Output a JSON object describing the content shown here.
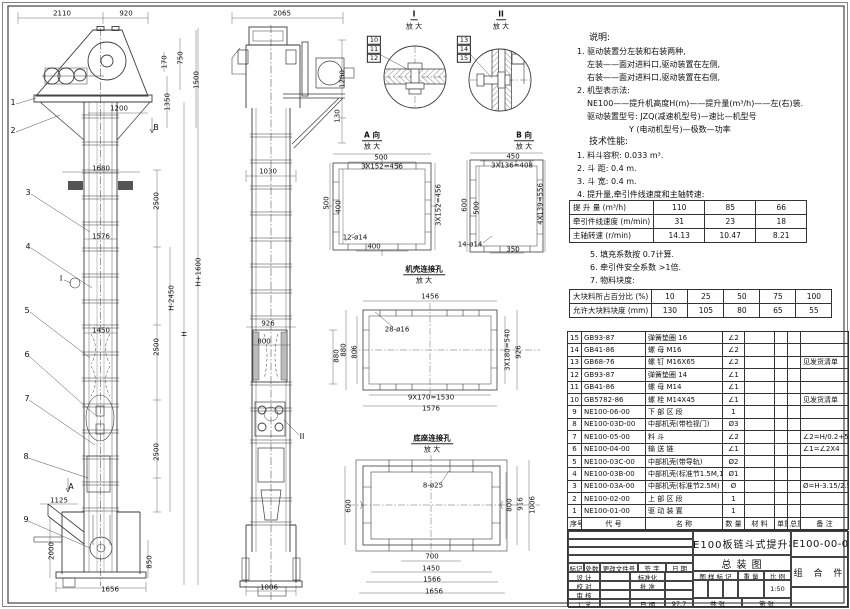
{
  "sheet": {
    "name": "NE100板链斗式提升机 总装图"
  },
  "notes_a": [
    {
      "t": "说明:",
      "c": "h"
    },
    {
      "t": "1. 驱动装置分左装和右装两种,",
      "c": ""
    },
    {
      "t": "左装——面对进料口,驱动装置在左侧,",
      "c": "i1"
    },
    {
      "t": "右装——面对进料口,驱动装置在右侧,",
      "c": "i1"
    },
    {
      "t": "2. 机型表示法:",
      "c": ""
    },
    {
      "t": "NE100——提升机高度H(m)——提升量(m³/h)——左(右)装.",
      "c": "i1"
    },
    {
      "t": "驱动装置型号: JZQ(减速机型号)—速比—机型号",
      "c": "i1"
    },
    {
      "t": "Y (电动机型号)—极数—功率",
      "c": "i2"
    },
    {
      "t": "技术性能:",
      "c": "h"
    },
    {
      "t": "1. 料斗容积: 0.033 m³.",
      "c": ""
    },
    {
      "t": "2. 斗  距: 0.4 m.",
      "c": ""
    },
    {
      "t": "3. 斗  宽: 0.4 m.",
      "c": ""
    },
    {
      "t": "4. 提升量,牵引件线速度和主轴转速:",
      "c": ""
    }
  ],
  "notes_b": [
    {
      "t": "5. 填充系数按 0.7计算.",
      "c": ""
    },
    {
      "t": "6. 牵引件安全系数 >1倍.",
      "c": ""
    },
    {
      "t": "7. 物料块度:",
      "c": ""
    }
  ],
  "perf_table": {
    "rows": [
      [
        "提 升 量 (m³/h)",
        "110",
        "85",
        "66"
      ],
      [
        "牵引件线速度 (m/min)",
        "31",
        "23",
        "18"
      ],
      [
        "主轴转速 (r/min)",
        "14.13",
        "10.47",
        "8.21"
      ]
    ]
  },
  "lump_table": {
    "rows": [
      [
        "大块料所占百分比 (%)",
        "10",
        "25",
        "50",
        "75",
        "100"
      ],
      [
        "允许大块料块度 (mm)",
        "130",
        "105",
        "80",
        "65",
        "55"
      ]
    ]
  },
  "bom": {
    "headers": [
      "序号",
      "代  号",
      "名  称",
      "数 量",
      "材  料",
      "单重",
      "总重",
      "备  注"
    ],
    "rows": [
      [
        "15",
        "GB93-87",
        "弹簧垫圈 16",
        "∠2",
        "",
        "",
        "",
        ""
      ],
      [
        "14",
        "GB41-86",
        "螺 母 M16",
        "∠2",
        "",
        "",
        "",
        ""
      ],
      [
        "13",
        "GB68-76",
        "螺 钉 M16X65",
        "∠2",
        "",
        "",
        "",
        "见发货清单"
      ],
      [
        "12",
        "GB93-87",
        "弹簧垫圈 14",
        "∠1",
        "",
        "",
        "",
        ""
      ],
      [
        "11",
        "GB41-86",
        "螺 母 M14",
        "∠1",
        "",
        "",
        "",
        ""
      ],
      [
        "10",
        "GB5782-86",
        "螺 栓 M14X45",
        "∠1",
        "",
        "",
        "",
        "见发货清单"
      ],
      [
        "9",
        "NE100-06-00",
        "下 部 区 段",
        "1",
        "",
        "",
        "",
        ""
      ],
      [
        "8",
        "NE100-03D-00",
        "中部机壳(带检视门)",
        "Ø3",
        "",
        "",
        "",
        ""
      ],
      [
        "7",
        "NE100-05-00",
        "料  斗",
        "∠2",
        "",
        "",
        "",
        "∠2=H/0.2+5.75"
      ],
      [
        "6",
        "NE100-04-00",
        "输 送 链",
        "∠1",
        "",
        "",
        "",
        "∠1=∠2X4"
      ],
      [
        "5",
        "NE100-03C-00",
        "中部机壳(带导轨)",
        "Ø2",
        "",
        "",
        "",
        ""
      ],
      [
        "4",
        "NE100-03B-00",
        "中部机壳(标准节1.5M,1M)",
        "Ø1",
        "",
        "",
        "",
        ""
      ],
      [
        "3",
        "NE100-03A-00",
        "中部机壳(标准节2.5M)",
        "Ø",
        "",
        "",
        "",
        "Ø=H-3.15/2.5"
      ],
      [
        "2",
        "NE100-02-00",
        "上 部 区 段",
        "1",
        "",
        "",
        "",
        ""
      ],
      [
        "1",
        "NE100-01-00",
        "驱 动 装 置",
        "1",
        "",
        "",
        "",
        ""
      ]
    ]
  },
  "title_block": {
    "rev_headers": [
      "标记",
      "处数",
      "更改文件号",
      "签 字",
      "日 期"
    ],
    "design": "设 计",
    "check": "校 对",
    "review": "审 核",
    "craft": "工 艺",
    "standard": "标准化",
    "approve": "批 准",
    "date_label": "日 期",
    "date_value": "97.7",
    "mark_label": "图 样 标 记",
    "weight_label": "重 量",
    "scale_label": "比 例",
    "scale_value": "1:50",
    "sheet_total": "共    张",
    "sheet_no": "第    张",
    "title_line1": "NE100板链斗式提升机",
    "title_line2": "总  装  图",
    "drawing_no": "NE100-00-00",
    "part_type": "组 合 件"
  },
  "annotations": [
    {
      "t": "2110",
      "x": 62,
      "y": 14
    },
    {
      "t": "920",
      "x": 126,
      "y": 14
    },
    {
      "t": "170",
      "x": 165,
      "y": 62,
      "r": 1
    },
    {
      "t": "750",
      "x": 181,
      "y": 58,
      "r": 1
    },
    {
      "t": "1350",
      "x": 168,
      "y": 102,
      "r": 1
    },
    {
      "t": "1500",
      "x": 197,
      "y": 80,
      "r": 1
    },
    {
      "t": "1200",
      "x": 119,
      "y": 109
    },
    {
      "t": "1",
      "x": 13,
      "y": 103,
      "c": "big"
    },
    {
      "t": "2",
      "x": 13,
      "y": 131,
      "c": "big"
    },
    {
      "t": "B",
      "x": 156,
      "y": 128,
      "c": "big"
    },
    {
      "t": "1680",
      "x": 101,
      "y": 169
    },
    {
      "t": "2500",
      "x": 157,
      "y": 201,
      "r": 1
    },
    {
      "t": "3",
      "x": 28,
      "y": 193,
      "c": "big"
    },
    {
      "t": "1576",
      "x": 101,
      "y": 237
    },
    {
      "t": "4",
      "x": 28,
      "y": 247,
      "c": "big"
    },
    {
      "t": "I",
      "x": 61,
      "y": 279,
      "c": "big"
    },
    {
      "t": "H-2450",
      "x": 172,
      "y": 298,
      "r": 1
    },
    {
      "t": "H",
      "x": 185,
      "y": 334,
      "r": 1
    },
    {
      "t": "H+1600",
      "x": 199,
      "y": 272,
      "r": 1
    },
    {
      "t": "1450",
      "x": 101,
      "y": 331
    },
    {
      "t": "2500",
      "x": 157,
      "y": 347,
      "r": 1
    },
    {
      "t": "5",
      "x": 27,
      "y": 311,
      "c": "big"
    },
    {
      "t": "6",
      "x": 27,
      "y": 355,
      "c": "big"
    },
    {
      "t": "7",
      "x": 27,
      "y": 399,
      "c": "big"
    },
    {
      "t": "2500",
      "x": 157,
      "y": 452,
      "r": 1
    },
    {
      "t": "8",
      "x": 26,
      "y": 457,
      "c": "big"
    },
    {
      "t": "A",
      "x": 71,
      "y": 487,
      "c": "big"
    },
    {
      "t": "1125",
      "x": 59,
      "y": 501
    },
    {
      "t": "9",
      "x": 26,
      "y": 520,
      "c": "big"
    },
    {
      "t": "2000",
      "x": 52,
      "y": 551,
      "r": 1
    },
    {
      "t": "850",
      "x": 150,
      "y": 562,
      "r": 1
    },
    {
      "t": "1656",
      "x": 110,
      "y": 590
    },
    {
      "t": "2065",
      "x": 282,
      "y": 14
    },
    {
      "t": "1200",
      "x": 343,
      "y": 79,
      "r": 1
    },
    {
      "t": "130",
      "x": 338,
      "y": 116,
      "r": 1
    },
    {
      "t": "1030",
      "x": 268,
      "y": 172
    },
    {
      "t": "926",
      "x": 268,
      "y": 324
    },
    {
      "t": "800",
      "x": 264,
      "y": 342
    },
    {
      "t": "880",
      "x": 337,
      "y": 356,
      "r": 1
    },
    {
      "t": "II",
      "x": 302,
      "y": 437,
      "c": "big"
    },
    {
      "t": "1006",
      "x": 269,
      "y": 588
    },
    {
      "t": "10",
      "x": 374,
      "y": 40,
      "c": "bx"
    },
    {
      "t": "11",
      "x": 374,
      "y": 49,
      "c": "bx"
    },
    {
      "t": "12",
      "x": 374,
      "y": 58,
      "c": "bx"
    },
    {
      "t": "13",
      "x": 464,
      "y": 40,
      "c": "bx"
    },
    {
      "t": "14",
      "x": 464,
      "y": 49,
      "c": "bx"
    },
    {
      "t": "15",
      "x": 464,
      "y": 58,
      "c": "bx"
    },
    {
      "t": "I",
      "x": 414,
      "y": 15,
      "c": "vt"
    },
    {
      "t": "放 大",
      "x": 414,
      "y": 27
    },
    {
      "t": "II",
      "x": 501,
      "y": 15,
      "c": "vt"
    },
    {
      "t": "放 大",
      "x": 501,
      "y": 27
    },
    {
      "t": "A 向",
      "x": 372,
      "y": 136,
      "c": "vt"
    },
    {
      "t": "放 大",
      "x": 372,
      "y": 147
    },
    {
      "t": "B 向",
      "x": 524,
      "y": 136,
      "c": "vt"
    },
    {
      "t": "放 大",
      "x": 524,
      "y": 147
    },
    {
      "t": "机壳连接孔",
      "x": 424,
      "y": 270,
      "c": "vt"
    },
    {
      "t": "放 大",
      "x": 424,
      "y": 281
    },
    {
      "t": "底座连接孔",
      "x": 432,
      "y": 439,
      "c": "vt"
    },
    {
      "t": "放 大",
      "x": 432,
      "y": 450
    },
    {
      "t": "500",
      "x": 381,
      "y": 158
    },
    {
      "t": "3X152=456",
      "x": 382,
      "y": 167
    },
    {
      "t": "500",
      "x": 327,
      "y": 203,
      "r": 1
    },
    {
      "t": "400",
      "x": 339,
      "y": 207,
      "r": 1
    },
    {
      "t": "3X152=456",
      "x": 439,
      "y": 205,
      "r": 1
    },
    {
      "t": "12-ø14",
      "x": 355,
      "y": 238
    },
    {
      "t": "400",
      "x": 374,
      "y": 247
    },
    {
      "t": "450",
      "x": 513,
      "y": 157
    },
    {
      "t": "3X136=408",
      "x": 512,
      "y": 166
    },
    {
      "t": "600",
      "x": 465,
      "y": 205,
      "r": 1
    },
    {
      "t": "500",
      "x": 477,
      "y": 208,
      "r": 1
    },
    {
      "t": "4X139=556",
      "x": 541,
      "y": 204,
      "r": 1
    },
    {
      "t": "14-ø14",
      "x": 470,
      "y": 245
    },
    {
      "t": "350",
      "x": 513,
      "y": 250
    },
    {
      "t": "1456",
      "x": 430,
      "y": 297
    },
    {
      "t": "28-ø16",
      "x": 397,
      "y": 330
    },
    {
      "t": "880",
      "x": 344,
      "y": 350,
      "r": 1
    },
    {
      "t": "806",
      "x": 355,
      "y": 352,
      "r": 1
    },
    {
      "t": "3X180=540",
      "x": 508,
      "y": 350,
      "r": 1
    },
    {
      "t": "926",
      "x": 519,
      "y": 352,
      "r": 1
    },
    {
      "t": "9X170=1530",
      "x": 431,
      "y": 398
    },
    {
      "t": "1576",
      "x": 431,
      "y": 409
    },
    {
      "t": "8-ø25",
      "x": 433,
      "y": 486
    },
    {
      "t": "600",
      "x": 349,
      "y": 506,
      "r": 1
    },
    {
      "t": "800",
      "x": 510,
      "y": 505,
      "r": 1
    },
    {
      "t": "916",
      "x": 521,
      "y": 504,
      "r": 1
    },
    {
      "t": "1006",
      "x": 533,
      "y": 505,
      "r": 1
    },
    {
      "t": "700",
      "x": 432,
      "y": 557
    },
    {
      "t": "1450",
      "x": 431,
      "y": 569
    },
    {
      "t": "1566",
      "x": 432,
      "y": 580
    },
    {
      "t": "1656",
      "x": 434,
      "y": 592
    }
  ]
}
